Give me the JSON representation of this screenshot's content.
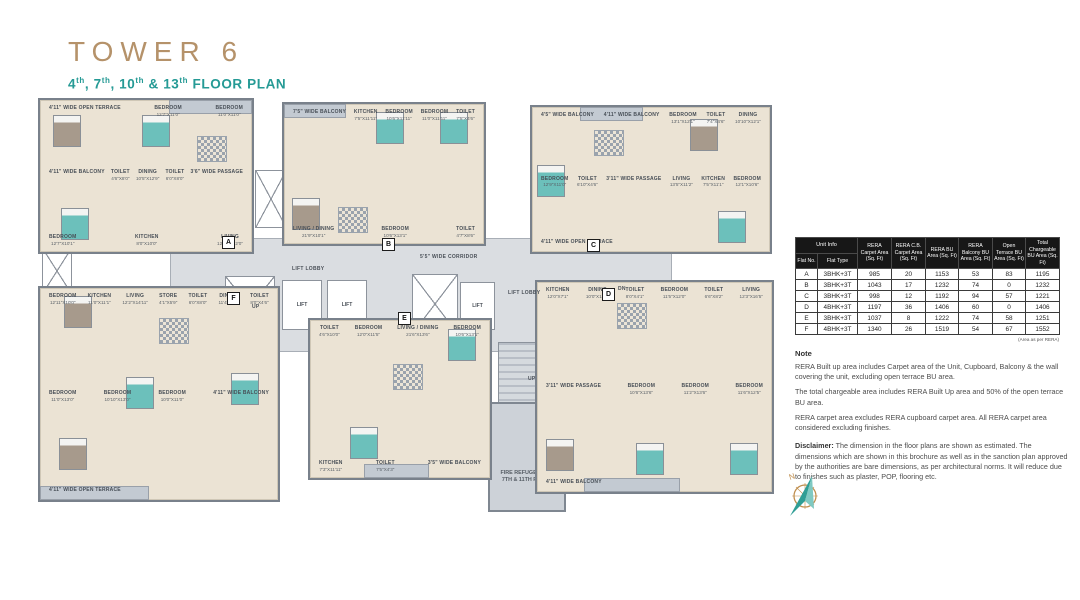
{
  "header": {
    "title": "TOWER 6",
    "subtitle": {
      "n1": "4",
      "s1": "th",
      "n2": ", 7",
      "s2": "th",
      "n3": ", 10",
      "s3": "th",
      "n4": " & 13",
      "s4": "th",
      "rest": " FLOOR PLAN"
    }
  },
  "plan": {
    "corridor_label": "5'5\" WIDE CORRIDOR",
    "lift_lobby_label": "LIFT LOBBY",
    "lift_label": "LIFT",
    "stair_up_label": "UP",
    "stair_dn_label": "DN",
    "fire_refuge_label": "FIRE REFUGE NEAR 7TH & 11TH FLOOR",
    "compass_north_label": "N",
    "units": [
      {
        "marker": "A",
        "type": "3BHK+3T",
        "rooms": [
          {
            "label": "4'11\" WIDE OPEN TERRACE"
          },
          {
            "label": "BEDROOM",
            "dims": "12'7\"X11'0\""
          },
          {
            "label": "BEDROOM",
            "dims": "11'0\"X11'0\""
          },
          {
            "label": "4'11\" WIDE BALCONY"
          },
          {
            "label": "TOILET",
            "dims": "4'6\"X8'0\""
          },
          {
            "label": "DINING",
            "dims": "10'5\"X12'9\""
          },
          {
            "label": "TOILET",
            "dims": "6'0\"X8'0\""
          },
          {
            "label": "3'6\" WIDE PASSAGE"
          },
          {
            "label": "BEDROOM",
            "dims": "12'7\"X10'1\""
          },
          {
            "label": "KITCHEN",
            "dims": "8'0\"X10'0\""
          },
          {
            "label": "LIVING",
            "dims": "12'10\"X12'0\""
          }
        ]
      },
      {
        "marker": "B",
        "type": "3BHK+3T",
        "rooms": [
          {
            "label": "7'5\" WIDE BALCONY"
          },
          {
            "label": "KITCHEN",
            "dims": "7'5\"X11'11\""
          },
          {
            "label": "BEDROOM",
            "dims": "10'6\"X11'11\""
          },
          {
            "label": "BEDROOM",
            "dims": "11'0\"X11'11\""
          },
          {
            "label": "TOILET",
            "dims": "7'5\"X4'6\""
          },
          {
            "label": "LIVING / DINING",
            "dims": "21'9\"X10'1\""
          },
          {
            "label": "BEDROOM",
            "dims": "10'6\"X13'1\""
          },
          {
            "label": "TOILET",
            "dims": "4'7\"X8'6\""
          }
        ]
      },
      {
        "marker": "C",
        "type": "3BHK+3T",
        "rooms": [
          {
            "label": "4'5\" WIDE BALCONY"
          },
          {
            "label": "4'11\" WIDE BALCONY"
          },
          {
            "label": "BEDROOM",
            "dims": "13'1\"X12'1\""
          },
          {
            "label": "TOILET",
            "dims": "7'4\"X4'6\""
          },
          {
            "label": "DINING",
            "dims": "10'10\"X12'1\""
          },
          {
            "label": "BEDROOM",
            "dims": "12'9\"X11'0\""
          },
          {
            "label": "TOILET",
            "dims": "6'10\"X4'6\""
          },
          {
            "label": "3'11\" WIDE PASSAGE"
          },
          {
            "label": "LIVING",
            "dims": "13'5\"X11'2\""
          },
          {
            "label": "KITCHEN",
            "dims": "7'5\"X11'1\""
          },
          {
            "label": "BEDROOM",
            "dims": "12'1\"X10'6\""
          },
          {
            "label": "4'11\" WIDE OPEN TERRACE"
          }
        ]
      },
      {
        "marker": "D",
        "type": "4BHK+3T",
        "rooms": [
          {
            "label": "KITCHEN",
            "dims": "12'0\"X7'1\""
          },
          {
            "label": "DINING",
            "dims": "10'0\"X13'4\""
          },
          {
            "label": "TOILET",
            "dims": "8'0\"X4'1\""
          },
          {
            "label": "BEDROOM",
            "dims": "11'5\"X12'0\""
          },
          {
            "label": "TOILET",
            "dims": "6'6\"X8'2\""
          },
          {
            "label": "LIVING",
            "dims": "12'3\"X16'5\""
          },
          {
            "label": "3'11\" WIDE PASSAGE"
          },
          {
            "label": "BEDROOM",
            "dims": "10'6\"X13'6\""
          },
          {
            "label": "BEDROOM",
            "dims": "11'2\"X13'6\""
          },
          {
            "label": "BEDROOM",
            "dims": "11'6\"X12'5\""
          },
          {
            "label": "4'11\" WIDE BALCONY"
          }
        ]
      },
      {
        "marker": "E",
        "type": "3BHK+3T",
        "rooms": [
          {
            "label": "TOILET",
            "dims": "4'6\"X10'0\""
          },
          {
            "label": "BEDROOM",
            "dims": "12'0\"X11'5\""
          },
          {
            "label": "LIVING / DINING",
            "dims": "21'6\"X13'6\""
          },
          {
            "label": "BEDROOM",
            "dims": "10'6\"X13'1\""
          },
          {
            "label": "KITCHEN",
            "dims": "7'3\"X11'11\""
          },
          {
            "label": "TOILET",
            "dims": "7'5\"X4'3\""
          },
          {
            "label": "3'5\" WIDE BALCONY"
          }
        ]
      },
      {
        "marker": "F",
        "type": "4BHK+3T",
        "rooms": [
          {
            "label": "BEDROOM",
            "dims": "12'11\"X10'0\""
          },
          {
            "label": "KITCHEN",
            "dims": "11'0\"X11'1\""
          },
          {
            "label": "LIVING",
            "dims": "12'2\"X14'11\""
          },
          {
            "label": "STORE",
            "dims": "4'1\"X5'9\""
          },
          {
            "label": "TOILET",
            "dims": "6'0\"X8'0\""
          },
          {
            "label": "DINING",
            "dims": "11'4\"X9'0\""
          },
          {
            "label": "TOILET",
            "dims": "8'0\"X4'6\""
          },
          {
            "label": "BEDROOM",
            "dims": "11'0\"X13'0\""
          },
          {
            "label": "BEDROOM",
            "dims": "10'10\"X13'0\""
          },
          {
            "label": "BEDROOM",
            "dims": "10'0\"X11'0\""
          },
          {
            "label": "4'11\" WIDE BALCONY"
          },
          {
            "label": "4'11\" WIDE OPEN TERRACE"
          }
        ]
      }
    ]
  },
  "table": {
    "group_header": "Unit Info",
    "columns": [
      "Flat No.",
      "Flat Type",
      "RERA Carpet Area (Sq. Ft)",
      "RERA C.B. Carpet Area (Sq. Ft)",
      "RERA BU Area (Sq. Ft)",
      "RERA Balcony BU Area (Sq. Ft)",
      "Open Terrace BU Area (Sq. Ft)",
      "Total Chargeable BU Area (Sq. Ft)"
    ],
    "rows": [
      [
        "A",
        "3BHK+3T",
        "985",
        "20",
        "1153",
        "53",
        "83",
        "1195"
      ],
      [
        "B",
        "3BHK+3T",
        "1043",
        "17",
        "1232",
        "74",
        "0",
        "1232"
      ],
      [
        "C",
        "3BHK+3T",
        "998",
        "12",
        "1192",
        "94",
        "57",
        "1221"
      ],
      [
        "D",
        "4BHK+3T",
        "1197",
        "36",
        "1406",
        "60",
        "0",
        "1406"
      ],
      [
        "E",
        "3BHK+3T",
        "1037",
        "8",
        "1222",
        "74",
        "58",
        "1251"
      ],
      [
        "F",
        "4BHK+3T",
        "1340",
        "26",
        "1519",
        "54",
        "67",
        "1552"
      ]
    ],
    "footnote": "(Area as per RERA)"
  },
  "notes": {
    "title": "Note",
    "paragraphs": [
      "RERA Built up area includes Carpet area of the Unit, Cupboard, Balcony & the wall covering the unit, excluding open terrace BU area.",
      "The total chargeable area includes RERA Built Up area and 50% of the open terrace BU area.",
      "RERA carpet area excludes RERA cupboard carpet area. All RERA carpet area considered excluding finishes."
    ],
    "disclaimer_label": "Disclaimer:",
    "disclaimer_text": " The dimension in the floor plans are shown as estimated. The dimensions which are shown in this brochure as well as in the sanction plan approved by the authorities are bare dimensions, as per architectural norms. It will reduce due to finishes such as plaster, POP, flooring etc."
  },
  "colors": {
    "title_gold": "#b5926a",
    "accent_teal": "#259a95",
    "wall_gray": "#79818b",
    "floor_beige": "#ebe3d4",
    "floor_gray": "#c3cad2",
    "bed_teal": "#6cc0bb",
    "table_header_bg": "#171717"
  }
}
